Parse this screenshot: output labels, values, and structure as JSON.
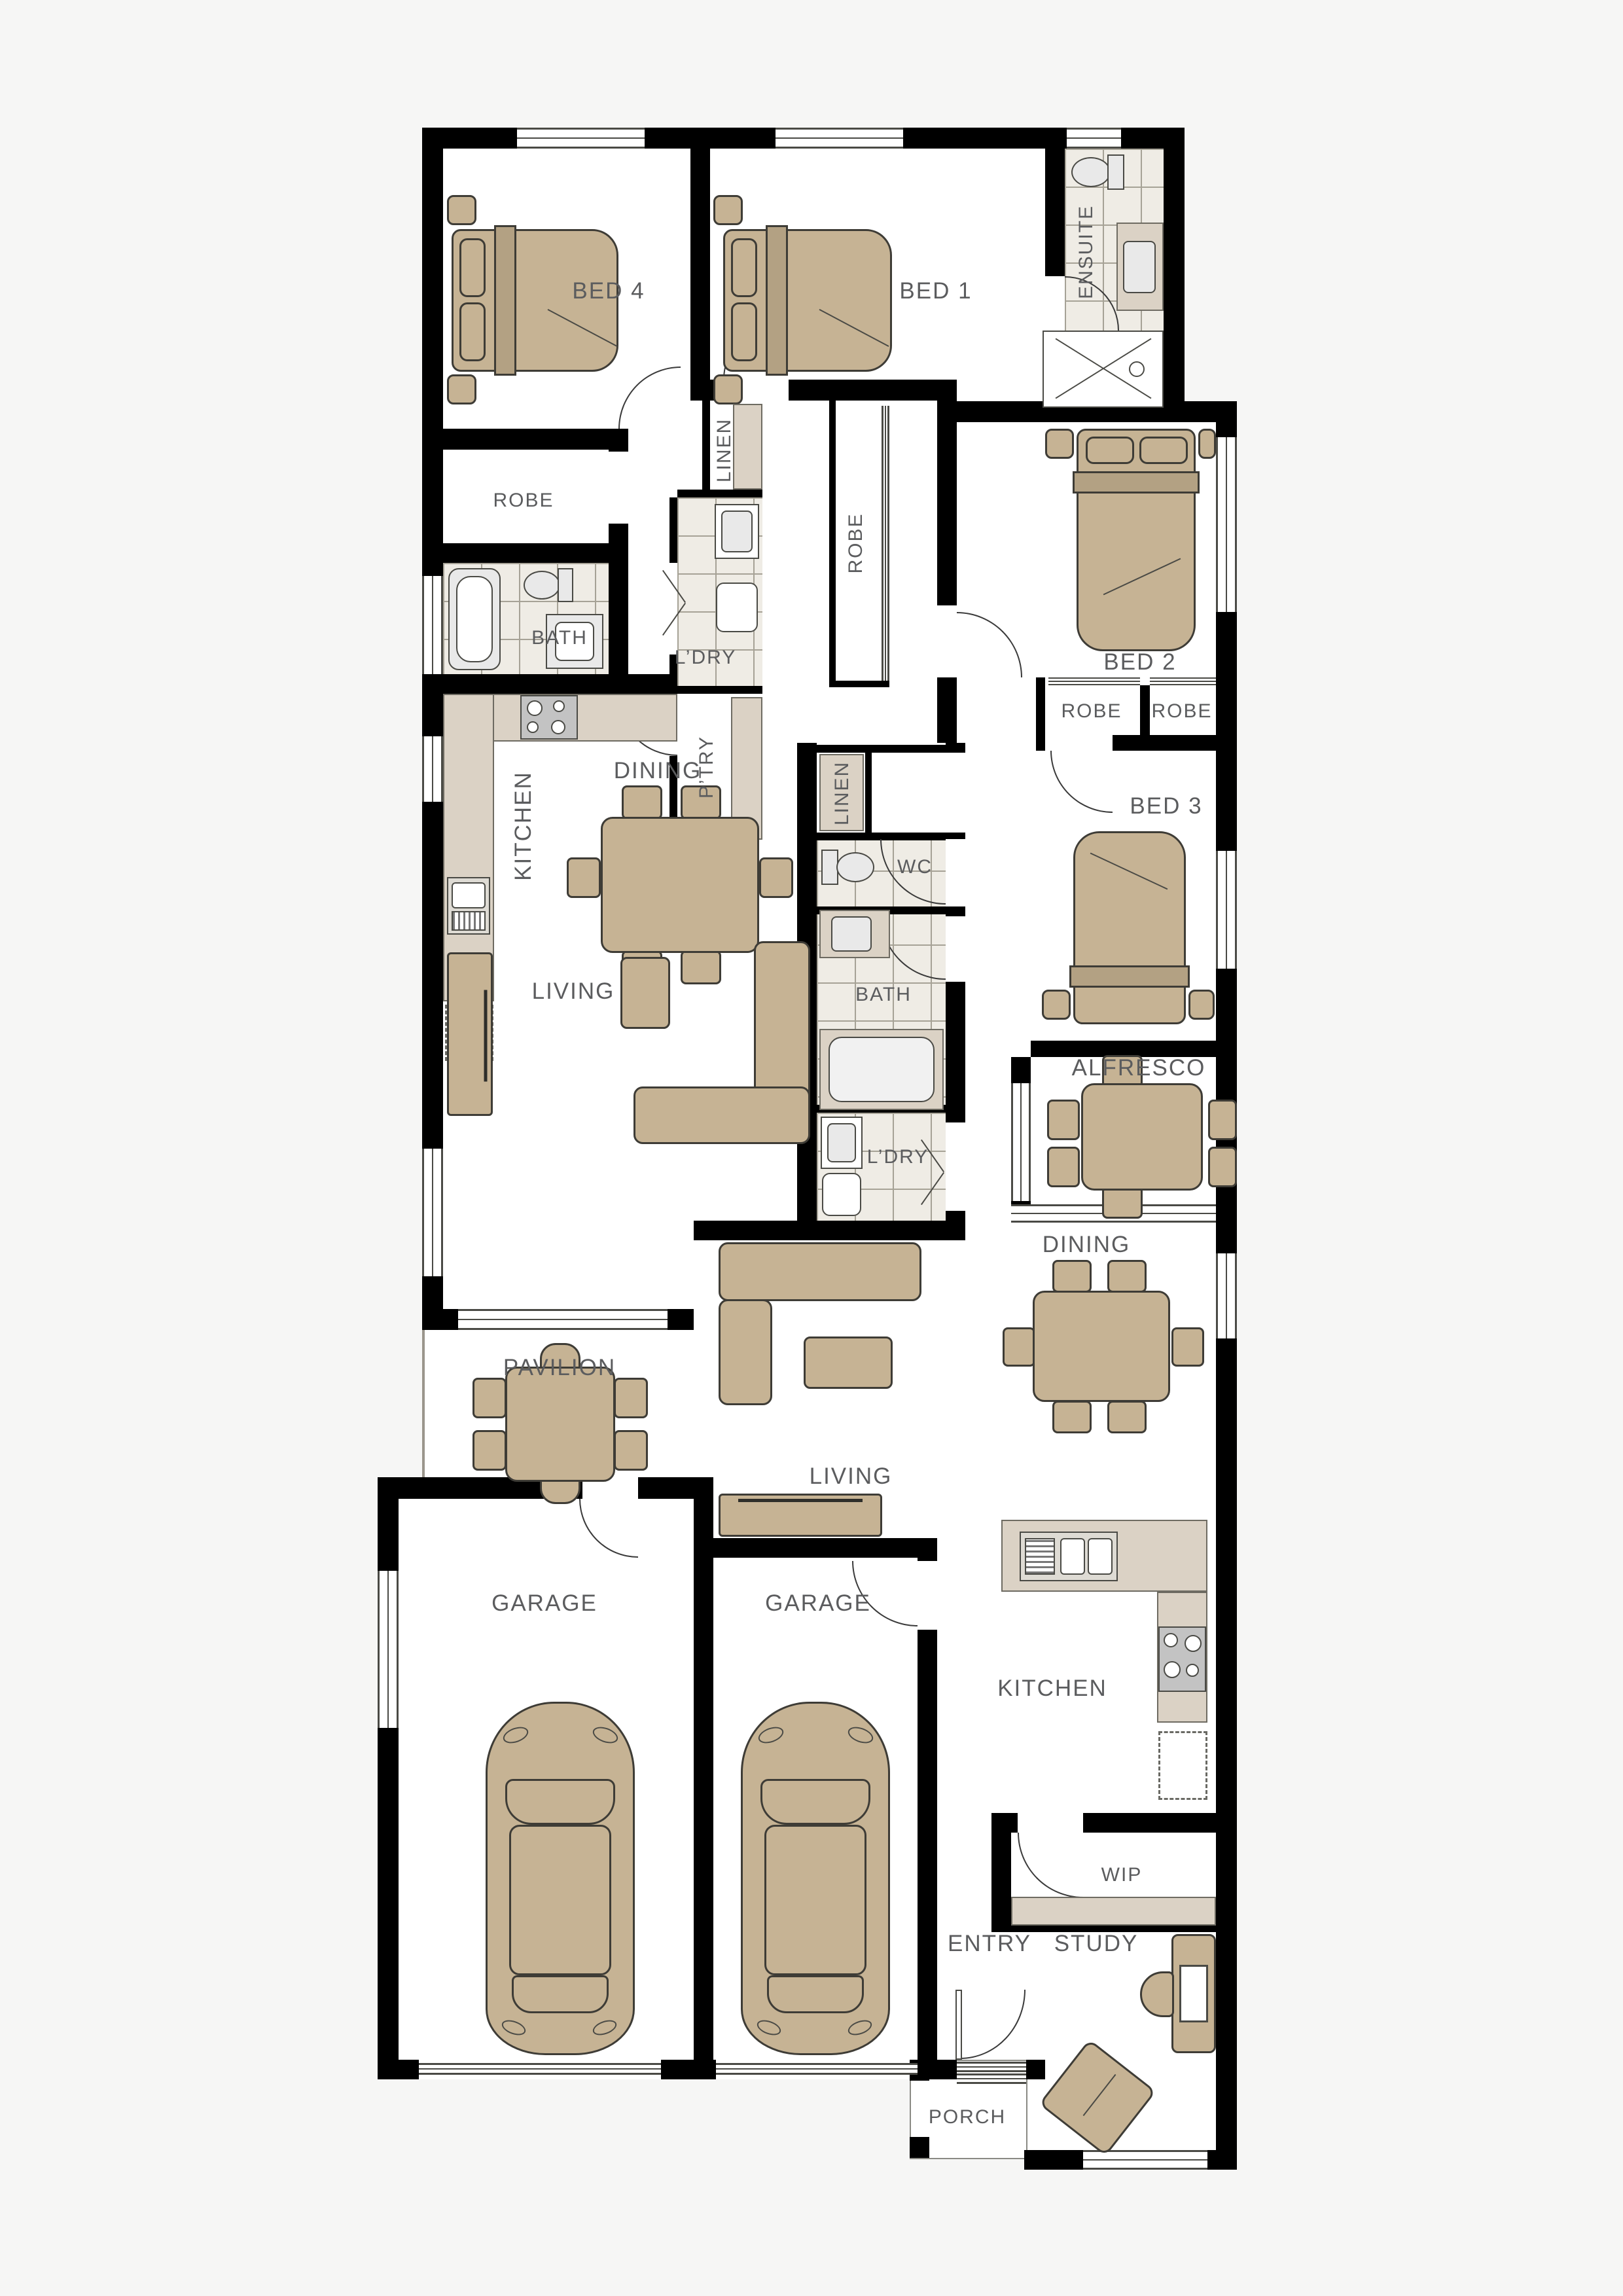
{
  "colors": {
    "wall": "#000000",
    "furniture": "#c6b394",
    "furniture_dark": "#b3a183",
    "counter": "#dbd2c5",
    "tile_floor": "#efece5",
    "fixture": "#e9e9e9",
    "label_text": "#5b5c5e",
    "background": "#f6f6f5",
    "floor": "#ffffff"
  },
  "labels": {
    "bed4": "BED 4",
    "bed1": "BED 1",
    "ensuite": "ENSUITE",
    "robe_bed4": "ROBE",
    "bath_a": "BATH",
    "linen_a": "LINEN",
    "ldry_a": "L’DRY",
    "robe_bed1": "ROBE",
    "ptry": "P’TRY",
    "kitchen_a": "KITCHEN",
    "dining_a": "DINING",
    "living_a": "LIVING",
    "pavilion": "PAVILION",
    "garage_a": "GARAGE",
    "bed2": "BED 2",
    "robe_bed2a": "ROBE",
    "robe_bed2b": "ROBE",
    "linen_b": "LINEN",
    "wc": "WC",
    "bath_b": "BATH",
    "bed3": "BED 3",
    "ldry_b": "L’DRY",
    "alfresco": "ALFRESCO",
    "dining_b": "DINING",
    "living_b": "LIVING",
    "garage_b": "GARAGE",
    "kitchen_b": "KITCHEN",
    "wip": "WIP",
    "entry": "ENTRY",
    "study": "STUDY",
    "porch": "PORCH"
  }
}
